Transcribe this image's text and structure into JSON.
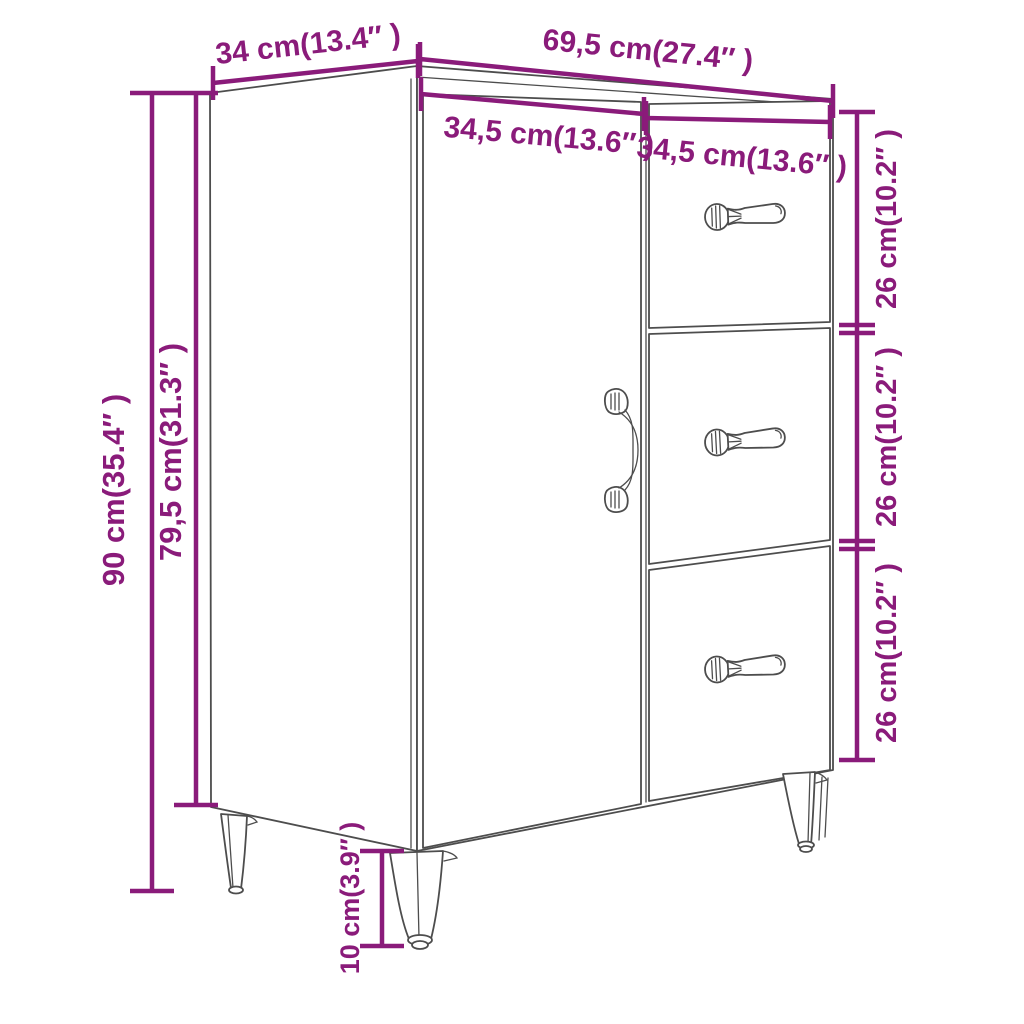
{
  "diagram": {
    "type": "furniture-dimension-diagram",
    "product": "sideboard with 1 door and 3 drawers on tapered legs",
    "colors": {
      "dimension_accent": "#8a1b7a",
      "outline": "#4d4d4d",
      "background": "#ffffff"
    },
    "labels": {
      "top_depth": "34 cm(13.4″ )",
      "top_width": "69,5 cm(27.4″ )",
      "door_width": "34,5 cm(13.6″ )",
      "drawer_width": "34,5 cm(13.6″ )",
      "total_height": "90 cm(35.4″ )",
      "body_height": "79,5 cm(31.3″ )",
      "drawer1_height": "26 cm(10.2″ )",
      "drawer2_height": "26 cm(10.2″ )",
      "drawer3_height": "26 cm(10.2″ )",
      "leg_height": "10 cm(3.9″ )"
    }
  }
}
